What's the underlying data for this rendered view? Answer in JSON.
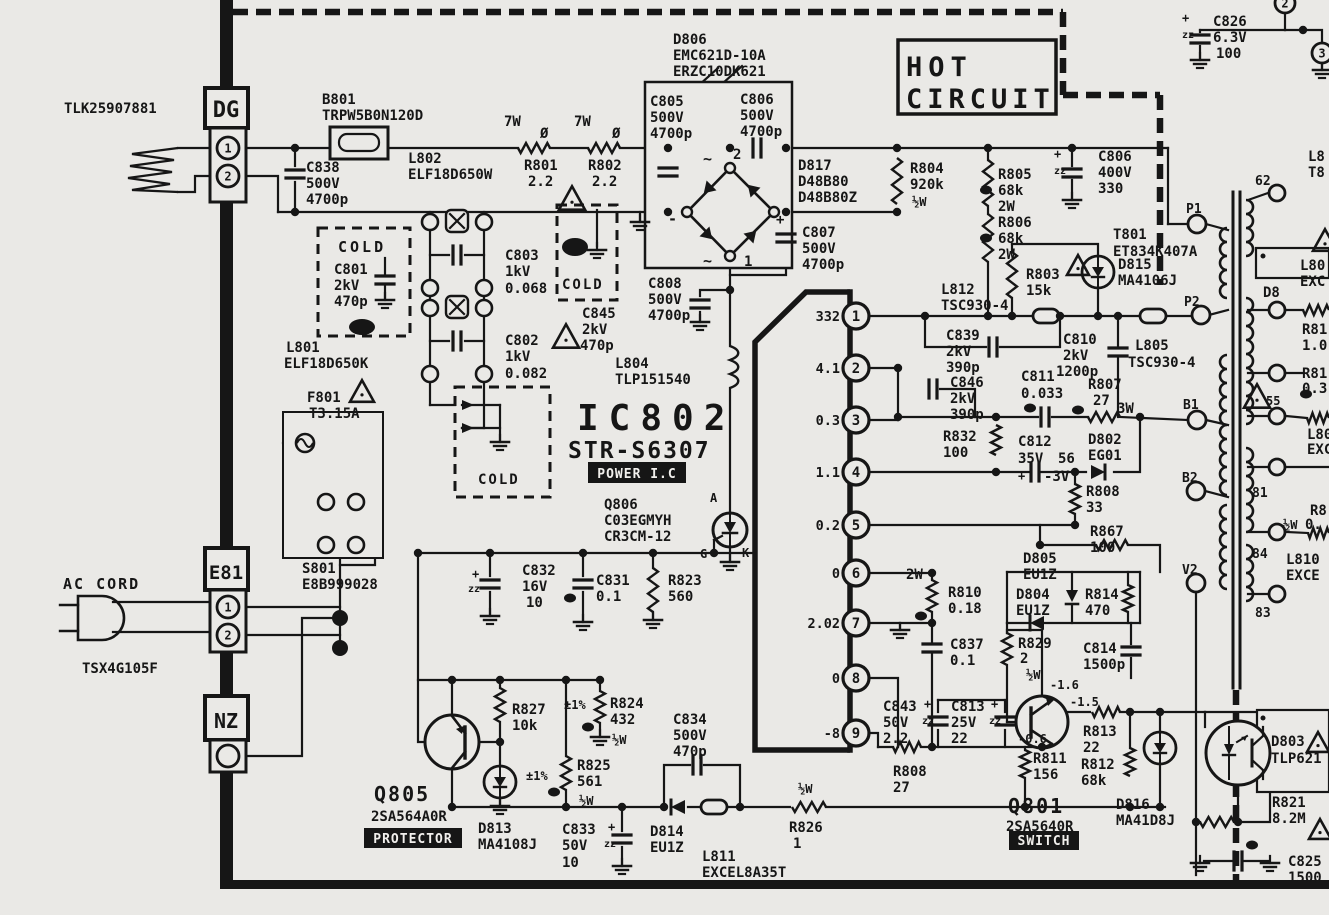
{
  "colors": {
    "background": "#eae9e6",
    "ink": "#161616"
  },
  "regions": {
    "hot": "HOT CIRCUIT",
    "cold": "COLD"
  },
  "ic802": {
    "ref": "IC802",
    "part": "STR-S6307",
    "tag": "POWER I.C",
    "pins": [
      {
        "n": "1",
        "v": "332",
        "y": 316
      },
      {
        "n": "2",
        "v": "4.1",
        "y": 368
      },
      {
        "n": "3",
        "v": "0.3",
        "y": 420
      },
      {
        "n": "4",
        "v": "1.1",
        "y": 472
      },
      {
        "n": "5",
        "v": "0.2",
        "y": 525
      },
      {
        "n": "6",
        "v": "0",
        "y": 573
      },
      {
        "n": "7",
        "v": "2.02",
        "y": 623
      },
      {
        "n": "8",
        "v": "0",
        "y": 678
      },
      {
        "n": "9",
        "v": "-8",
        "y": 733
      }
    ]
  },
  "inverted": [
    {
      "t": "POWER I.C",
      "x": 588,
      "y": 462,
      "w": 98,
      "h": 21
    },
    {
      "t": "PROTECTOR",
      "x": 364,
      "y": 828,
      "w": 98,
      "h": 20
    },
    {
      "t": "SWITCH",
      "x": 1009,
      "y": 831,
      "w": 70,
      "h": 19
    }
  ],
  "terminals": [
    {
      "t": "P1",
      "x": 1197,
      "y": 224,
      "r": 9,
      "lx": 1186,
      "ly": 213
    },
    {
      "t": "P2",
      "x": 1201,
      "y": 315,
      "r": 9,
      "lx": 1184,
      "ly": 306
    },
    {
      "t": "B1",
      "x": 1197,
      "y": 420,
      "r": 9,
      "lx": 1183,
      "ly": 409
    },
    {
      "t": "B2",
      "x": 1196,
      "y": 491,
      "r": 9,
      "lx": 1182,
      "ly": 482
    },
    {
      "t": "V2",
      "x": 1196,
      "y": 583,
      "r": 9,
      "lx": 1182,
      "ly": 574
    },
    {
      "t": "62",
      "x": 1277,
      "y": 193,
      "r": 8,
      "lx": 1255,
      "ly": 185
    },
    {
      "t": "81",
      "x": 1277,
      "y": 467,
      "r": 8,
      "lx": 1252,
      "ly": 497
    },
    {
      "t": "84",
      "x": 1277,
      "y": 532,
      "r": 8,
      "lx": 1252,
      "ly": 558
    },
    {
      "t": "83",
      "x": 1277,
      "y": 594,
      "r": 8,
      "lx": 1255,
      "ly": 617
    },
    {
      "t": "",
      "x": 1277,
      "y": 310,
      "r": 8
    },
    {
      "t": "",
      "x": 1277,
      "y": 373,
      "r": 8
    },
    {
      "t": "",
      "x": 1277,
      "y": 416,
      "r": 8
    },
    {
      "t": "1",
      "x": 228,
      "y": 148,
      "r": 11,
      "in": true
    },
    {
      "t": "2",
      "x": 228,
      "y": 176,
      "r": 11,
      "in": true
    },
    {
      "t": "1",
      "x": 228,
      "y": 607,
      "r": 11,
      "in": true
    },
    {
      "t": "2",
      "x": 228,
      "y": 635,
      "r": 11,
      "in": true
    },
    {
      "t": "",
      "x": 228,
      "y": 756,
      "r": 11
    },
    {
      "t": "2",
      "x": 1285,
      "y": 3,
      "r": 10,
      "in": true
    },
    {
      "t": "3",
      "x": 1322,
      "y": 53,
      "r": 10,
      "in": true
    }
  ],
  "labels": [
    {
      "t": "TLK25907881",
      "x": 64,
      "y": 113
    },
    {
      "t": "DG",
      "x": 226,
      "y": 117,
      "s": 22,
      "a": "m"
    },
    {
      "t": "E81",
      "x": 226,
      "y": 579,
      "s": 19,
      "a": "m"
    },
    {
      "t": "NZ",
      "x": 226,
      "y": 728,
      "s": 20,
      "a": "m"
    },
    {
      "t": "B801",
      "x": 322,
      "y": 104
    },
    {
      "t": "TRPW5B0N120D",
      "x": 322,
      "y": 120
    },
    {
      "t": "C838",
      "x": 306,
      "y": 172
    },
    {
      "t": "500V",
      "x": 306,
      "y": 188
    },
    {
      "t": "4700p",
      "x": 306,
      "y": 204
    },
    {
      "t": "L802",
      "x": 408,
      "y": 163
    },
    {
      "t": "ELF18D650W",
      "x": 408,
      "y": 179
    },
    {
      "t": "7W",
      "x": 504,
      "y": 126
    },
    {
      "t": "Ø",
      "x": 540,
      "y": 138
    },
    {
      "t": "7W",
      "x": 574,
      "y": 126
    },
    {
      "t": "Ø",
      "x": 612,
      "y": 138
    },
    {
      "t": "R801",
      "x": 524,
      "y": 170
    },
    {
      "t": "2.2",
      "x": 528,
      "y": 186
    },
    {
      "t": "R802",
      "x": 588,
      "y": 170
    },
    {
      "t": "2.2",
      "x": 592,
      "y": 186
    },
    {
      "t": "D806",
      "x": 673,
      "y": 44
    },
    {
      "t": "EMC621D-10A",
      "x": 673,
      "y": 60
    },
    {
      "t": "ERZC10DK621",
      "x": 673,
      "y": 76
    },
    {
      "t": "C805",
      "x": 650,
      "y": 106
    },
    {
      "t": "500V",
      "x": 650,
      "y": 122
    },
    {
      "t": "4700p",
      "x": 650,
      "y": 138
    },
    {
      "t": "C806",
      "x": 740,
      "y": 104
    },
    {
      "t": "500V",
      "x": 740,
      "y": 120
    },
    {
      "t": "4700p",
      "x": 740,
      "y": 136
    },
    {
      "t": "~",
      "x": 703,
      "y": 164,
      "s": 15
    },
    {
      "t": "2",
      "x": 733,
      "y": 159
    },
    {
      "t": "~",
      "x": 703,
      "y": 266,
      "s": 15
    },
    {
      "t": "1",
      "x": 744,
      "y": 266
    },
    {
      "t": "+",
      "x": 776,
      "y": 224
    },
    {
      "t": "-",
      "x": 668,
      "y": 224,
      "s": 15
    },
    {
      "t": "D817",
      "x": 798,
      "y": 170
    },
    {
      "t": "D48B80",
      "x": 798,
      "y": 186
    },
    {
      "t": "D48B80Z",
      "x": 798,
      "y": 202
    },
    {
      "t": "C807",
      "x": 802,
      "y": 237
    },
    {
      "t": "500V",
      "x": 802,
      "y": 253
    },
    {
      "t": "4700p",
      "x": 802,
      "y": 269
    },
    {
      "t": "C808",
      "x": 648,
      "y": 288
    },
    {
      "t": "500V",
      "x": 648,
      "y": 304
    },
    {
      "t": "4700p",
      "x": 648,
      "y": 320
    },
    {
      "t": "COLD",
      "x": 338,
      "y": 252,
      "s": 15,
      "ls": 3
    },
    {
      "t": "C801",
      "x": 334,
      "y": 274
    },
    {
      "t": "2kV",
      "x": 334,
      "y": 290
    },
    {
      "t": "470p",
      "x": 334,
      "y": 306
    },
    {
      "t": "L801",
      "x": 286,
      "y": 352
    },
    {
      "t": "ELF18D650K",
      "x": 284,
      "y": 368
    },
    {
      "t": "C803",
      "x": 505,
      "y": 260
    },
    {
      "t": "1kV",
      "x": 505,
      "y": 276
    },
    {
      "t": "0.068",
      "x": 505,
      "y": 293
    },
    {
      "t": "C802",
      "x": 505,
      "y": 345
    },
    {
      "t": "1kV",
      "x": 505,
      "y": 361
    },
    {
      "t": "0.082",
      "x": 505,
      "y": 378
    },
    {
      "t": "COLD",
      "x": 562,
      "y": 289,
      "s": 14,
      "ls": 2
    },
    {
      "t": "C845",
      "x": 582,
      "y": 318
    },
    {
      "t": "2kV",
      "x": 582,
      "y": 334
    },
    {
      "t": "470p",
      "x": 580,
      "y": 350
    },
    {
      "t": "F801",
      "x": 307,
      "y": 402
    },
    {
      "t": "T3.15A",
      "x": 309,
      "y": 418
    },
    {
      "t": "COLD",
      "x": 478,
      "y": 484,
      "s": 14,
      "ls": 2
    },
    {
      "t": "L804",
      "x": 615,
      "y": 368
    },
    {
      "t": "TLP151540",
      "x": 615,
      "y": 384
    },
    {
      "t": "IC802",
      "x": 577,
      "y": 430,
      "s": 36,
      "ls": 10
    },
    {
      "t": "STR-S6307",
      "x": 568,
      "y": 458,
      "s": 23,
      "ls": 2
    },
    {
      "t": "Q806",
      "x": 604,
      "y": 509
    },
    {
      "t": "C03EGMYH",
      "x": 604,
      "y": 525
    },
    {
      "t": "CR3CM-12",
      "x": 604,
      "y": 541
    },
    {
      "t": "A",
      "x": 710,
      "y": 502,
      "s": 12
    },
    {
      "t": "G",
      "x": 700,
      "y": 558,
      "s": 12
    },
    {
      "t": "K",
      "x": 742,
      "y": 557,
      "s": 12
    },
    {
      "t": "C832",
      "x": 522,
      "y": 575
    },
    {
      "t": "16V",
      "x": 522,
      "y": 591
    },
    {
      "t": "10",
      "x": 526,
      "y": 607
    },
    {
      "t": "+",
      "x": 472,
      "y": 578,
      "s": 12
    },
    {
      "t": "zz",
      "x": 468,
      "y": 592,
      "s": 10
    },
    {
      "t": "C831",
      "x": 596,
      "y": 585
    },
    {
      "t": "0.1",
      "x": 596,
      "y": 601
    },
    {
      "t": "R823",
      "x": 668,
      "y": 585
    },
    {
      "t": "560",
      "x": 668,
      "y": 601
    },
    {
      "t": "AC CORD",
      "x": 63,
      "y": 589,
      "s": 15,
      "ls": 2
    },
    {
      "t": "TSX4G105F",
      "x": 82,
      "y": 673
    },
    {
      "t": "S801",
      "x": 302,
      "y": 573
    },
    {
      "t": "E8B999028",
      "x": 302,
      "y": 589
    },
    {
      "t": "Q805",
      "x": 374,
      "y": 801,
      "s": 20,
      "ls": 2
    },
    {
      "t": "2SA564A0R",
      "x": 371,
      "y": 821
    },
    {
      "t": "R827",
      "x": 512,
      "y": 714
    },
    {
      "t": "10k",
      "x": 512,
      "y": 730
    },
    {
      "t": "D813",
      "x": 478,
      "y": 833
    },
    {
      "t": "MA4108J",
      "x": 478,
      "y": 849
    },
    {
      "t": "±1%",
      "x": 564,
      "y": 709,
      "s": 12
    },
    {
      "t": "R824",
      "x": 610,
      "y": 708
    },
    {
      "t": "432",
      "x": 610,
      "y": 724
    },
    {
      "t": "½W",
      "x": 612,
      "y": 744,
      "s": 12
    },
    {
      "t": "±1%",
      "x": 526,
      "y": 780,
      "s": 12
    },
    {
      "t": "R825",
      "x": 577,
      "y": 770
    },
    {
      "t": "561",
      "x": 577,
      "y": 786
    },
    {
      "t": "½W",
      "x": 579,
      "y": 805,
      "s": 12
    },
    {
      "t": "C833",
      "x": 562,
      "y": 834
    },
    {
      "t": "50V",
      "x": 562,
      "y": 850
    },
    {
      "t": "10",
      "x": 562,
      "y": 867
    },
    {
      "t": "+",
      "x": 608,
      "y": 831,
      "s": 12
    },
    {
      "t": "zz",
      "x": 604,
      "y": 847,
      "s": 10
    },
    {
      "t": "C834",
      "x": 673,
      "y": 724
    },
    {
      "t": "500V",
      "x": 673,
      "y": 740
    },
    {
      "t": "470p",
      "x": 673,
      "y": 756
    },
    {
      "t": "D814",
      "x": 650,
      "y": 836
    },
    {
      "t": "EU1Z",
      "x": 650,
      "y": 852
    },
    {
      "t": "L811",
      "x": 702,
      "y": 861
    },
    {
      "t": "EXCEL8A35T",
      "x": 702,
      "y": 877
    },
    {
      "t": "½W",
      "x": 798,
      "y": 793,
      "s": 12
    },
    {
      "t": "R826",
      "x": 789,
      "y": 832
    },
    {
      "t": "1",
      "x": 793,
      "y": 848
    },
    {
      "t": "Q801",
      "x": 1008,
      "y": 813,
      "s": 20,
      "ls": 2
    },
    {
      "t": "2SA5640R",
      "x": 1006,
      "y": 831
    },
    {
      "t": "D816",
      "x": 1116,
      "y": 809
    },
    {
      "t": "MA41D8J",
      "x": 1116,
      "y": 825
    },
    {
      "t": "D803",
      "x": 1271,
      "y": 746
    },
    {
      "t": "TLP621",
      "x": 1271,
      "y": 763
    },
    {
      "t": "R821",
      "x": 1272,
      "y": 807
    },
    {
      "t": "8.2M",
      "x": 1272,
      "y": 823
    },
    {
      "t": "C825",
      "x": 1288,
      "y": 866
    },
    {
      "t": "1500",
      "x": 1288,
      "y": 882
    },
    {
      "t": "HOT",
      "x": 906,
      "y": 76,
      "s": 27,
      "ls": 6
    },
    {
      "t": "CIRCUIT",
      "x": 906,
      "y": 108,
      "s": 27,
      "ls": 5
    },
    {
      "t": "C826",
      "x": 1213,
      "y": 26
    },
    {
      "t": "6.3V",
      "x": 1213,
      "y": 42
    },
    {
      "t": "100",
      "x": 1216,
      "y": 58
    },
    {
      "t": "+",
      "x": 1182,
      "y": 22,
      "s": 12
    },
    {
      "t": "zz",
      "x": 1182,
      "y": 38,
      "s": 10
    },
    {
      "t": "R804",
      "x": 910,
      "y": 173
    },
    {
      "t": "920k",
      "x": 910,
      "y": 189
    },
    {
      "t": "½W",
      "x": 912,
      "y": 206,
      "s": 12
    },
    {
      "t": "R805",
      "x": 998,
      "y": 179
    },
    {
      "t": "68k",
      "x": 998,
      "y": 195
    },
    {
      "t": "2W",
      "x": 998,
      "y": 211
    },
    {
      "t": "R806",
      "x": 998,
      "y": 227
    },
    {
      "t": "68k",
      "x": 998,
      "y": 243
    },
    {
      "t": "2W",
      "x": 998,
      "y": 259
    },
    {
      "t": "C806",
      "x": 1098,
      "y": 161
    },
    {
      "t": "400V",
      "x": 1098,
      "y": 177
    },
    {
      "t": "330",
      "x": 1098,
      "y": 193
    },
    {
      "t": "+",
      "x": 1054,
      "y": 158,
      "s": 12
    },
    {
      "t": "zz",
      "x": 1054,
      "y": 174,
      "s": 10
    },
    {
      "t": "R803",
      "x": 1026,
      "y": 279
    },
    {
      "t": "15k",
      "x": 1026,
      "y": 295
    },
    {
      "t": "D815",
      "x": 1118,
      "y": 269
    },
    {
      "t": "MA4106J",
      "x": 1118,
      "y": 285
    },
    {
      "t": "T801",
      "x": 1113,
      "y": 239
    },
    {
      "t": "ET834K407A",
      "x": 1113,
      "y": 256
    },
    {
      "t": "L812",
      "x": 941,
      "y": 294
    },
    {
      "t": "TSC930-4",
      "x": 941,
      "y": 310
    },
    {
      "t": "C839",
      "x": 946,
      "y": 340
    },
    {
      "t": "2kV",
      "x": 946,
      "y": 356
    },
    {
      "t": "390p",
      "x": 946,
      "y": 372
    },
    {
      "t": "C846",
      "x": 950,
      "y": 387
    },
    {
      "t": "2kV",
      "x": 950,
      "y": 403
    },
    {
      "t": "390p",
      "x": 950,
      "y": 419
    },
    {
      "t": "C810",
      "x": 1063,
      "y": 344
    },
    {
      "t": "2kV",
      "x": 1063,
      "y": 360
    },
    {
      "t": "1200p",
      "x": 1056,
      "y": 376
    },
    {
      "t": "L805",
      "x": 1135,
      "y": 350
    },
    {
      "t": "TSC930-4",
      "x": 1128,
      "y": 367
    },
    {
      "t": "C811",
      "x": 1021,
      "y": 381
    },
    {
      "t": "0.033",
      "x": 1021,
      "y": 398
    },
    {
      "t": "R807",
      "x": 1088,
      "y": 389
    },
    {
      "t": "27",
      "x": 1093,
      "y": 405
    },
    {
      "t": "3W",
      "x": 1117,
      "y": 413
    },
    {
      "t": "R832",
      "x": 943,
      "y": 441
    },
    {
      "t": "100",
      "x": 943,
      "y": 457
    },
    {
      "t": "C812",
      "x": 1018,
      "y": 446
    },
    {
      "t": "35V",
      "x": 1018,
      "y": 463
    },
    {
      "t": "56",
      "x": 1058,
      "y": 463
    },
    {
      "t": "+",
      "x": 1018,
      "y": 480,
      "s": 12
    },
    {
      "t": "-3V",
      "x": 1044,
      "y": 481
    },
    {
      "t": "D802",
      "x": 1088,
      "y": 444
    },
    {
      "t": "EG01",
      "x": 1088,
      "y": 460
    },
    {
      "t": "R808",
      "x": 1086,
      "y": 496
    },
    {
      "t": "33",
      "x": 1086,
      "y": 512
    },
    {
      "t": "R867",
      "x": 1090,
      "y": 536
    },
    {
      "t": "100",
      "x": 1090,
      "y": 552
    },
    {
      "t": "2W",
      "x": 906,
      "y": 579
    },
    {
      "t": "R810",
      "x": 948,
      "y": 597
    },
    {
      "t": "0.18",
      "x": 948,
      "y": 613
    },
    {
      "t": "C837",
      "x": 950,
      "y": 649
    },
    {
      "t": "0.1",
      "x": 950,
      "y": 665
    },
    {
      "t": "D805",
      "x": 1023,
      "y": 563
    },
    {
      "t": "EU1Z",
      "x": 1023,
      "y": 579
    },
    {
      "t": "D804",
      "x": 1016,
      "y": 599
    },
    {
      "t": "EU1Z",
      "x": 1016,
      "y": 615
    },
    {
      "t": "R814",
      "x": 1085,
      "y": 599
    },
    {
      "t": "470",
      "x": 1085,
      "y": 615
    },
    {
      "t": "R829",
      "x": 1018,
      "y": 648
    },
    {
      "t": "2",
      "x": 1020,
      "y": 663
    },
    {
      "t": "½W",
      "x": 1026,
      "y": 679,
      "s": 12
    },
    {
      "t": "C814",
      "x": 1083,
      "y": 653
    },
    {
      "t": "1500p",
      "x": 1083,
      "y": 669
    },
    {
      "t": "C843",
      "x": 883,
      "y": 711
    },
    {
      "t": "50V",
      "x": 883,
      "y": 727
    },
    {
      "t": "2.2",
      "x": 883,
      "y": 743
    },
    {
      "t": "+",
      "x": 924,
      "y": 708,
      "s": 12
    },
    {
      "t": "zz",
      "x": 922,
      "y": 724,
      "s": 10
    },
    {
      "t": "C813",
      "x": 951,
      "y": 711
    },
    {
      "t": "25V",
      "x": 951,
      "y": 727
    },
    {
      "t": "22",
      "x": 951,
      "y": 743
    },
    {
      "t": "+",
      "x": 991,
      "y": 708,
      "s": 12
    },
    {
      "t": "zz",
      "x": 989,
      "y": 724,
      "s": 10
    },
    {
      "t": "R808",
      "x": 893,
      "y": 776
    },
    {
      "t": "27",
      "x": 893,
      "y": 792
    },
    {
      "t": "R811",
      "x": 1033,
      "y": 763
    },
    {
      "t": "156",
      "x": 1033,
      "y": 779
    },
    {
      "t": "R813",
      "x": 1083,
      "y": 736
    },
    {
      "t": "22",
      "x": 1083,
      "y": 752
    },
    {
      "t": "R812",
      "x": 1081,
      "y": 769
    },
    {
      "t": "68k",
      "x": 1081,
      "y": 785
    },
    {
      "t": "-1.6",
      "x": 1050,
      "y": 689,
      "s": 12
    },
    {
      "t": "-1.5",
      "x": 1070,
      "y": 706,
      "s": 12
    },
    {
      "t": "-0.6",
      "x": 1018,
      "y": 743,
      "s": 12
    },
    {
      "t": "L810",
      "x": 1286,
      "y": 564
    },
    {
      "t": "EXCE",
      "x": 1286,
      "y": 580
    },
    {
      "t": "L80",
      "x": 1300,
      "y": 270
    },
    {
      "t": "EXC",
      "x": 1300,
      "y": 286
    },
    {
      "t": "R81",
      "x": 1302,
      "y": 334
    },
    {
      "t": "1.0",
      "x": 1302,
      "y": 350
    },
    {
      "t": "R81",
      "x": 1302,
      "y": 378
    },
    {
      "t": "0.3",
      "x": 1302,
      "y": 393
    },
    {
      "t": "L80",
      "x": 1307,
      "y": 439
    },
    {
      "t": "EXC",
      "x": 1307,
      "y": 454
    },
    {
      "t": "R8",
      "x": 1310,
      "y": 515
    },
    {
      "t": "½W",
      "x": 1283,
      "y": 529,
      "s": 12
    },
    {
      "t": "0.",
      "x": 1305,
      "y": 529
    },
    {
      "t": "55",
      "x": 1266,
      "y": 405,
      "s": 12
    },
    {
      "t": "D8",
      "x": 1263,
      "y": 297
    },
    {
      "t": "L8",
      "x": 1308,
      "y": 161
    },
    {
      "t": "T8",
      "x": 1308,
      "y": 177
    }
  ]
}
